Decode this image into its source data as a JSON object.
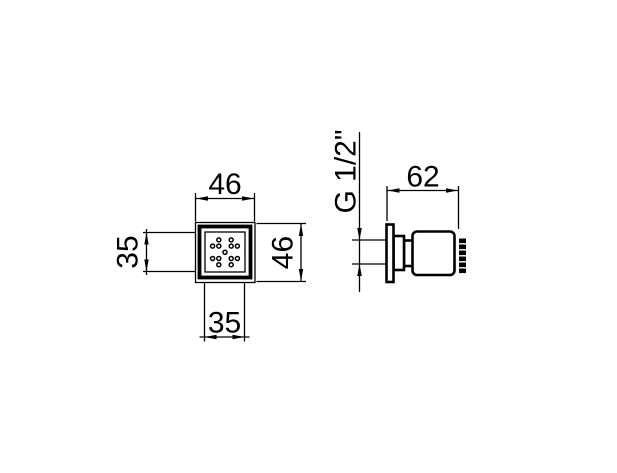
{
  "drawing_title": "shower body jet technical drawing",
  "colors": {
    "background": "#ffffff",
    "line": "#000000"
  },
  "front_view": {
    "dim_width_top": "46",
    "dim_height_right": "46",
    "dim_face_height_left": "35",
    "dim_face_width_bottom": "35",
    "nozzle_dots": {
      "center": [
        225,
        252.3
      ],
      "spacing": 6.2,
      "radius": 2,
      "offsets": [
        [
          -1,
          -2
        ],
        [
          1,
          -2
        ],
        [
          -2,
          -1
        ],
        [
          -1,
          -1
        ],
        [
          1,
          -1
        ],
        [
          2,
          -1
        ],
        [
          0,
          0
        ],
        [
          -2,
          1
        ],
        [
          -1,
          1
        ],
        [
          1,
          1
        ],
        [
          2,
          1
        ],
        [
          -1,
          2
        ],
        [
          1,
          2
        ]
      ]
    }
  },
  "side_view": {
    "dim_depth_top": "62",
    "thread_label": "G 1/2\""
  }
}
